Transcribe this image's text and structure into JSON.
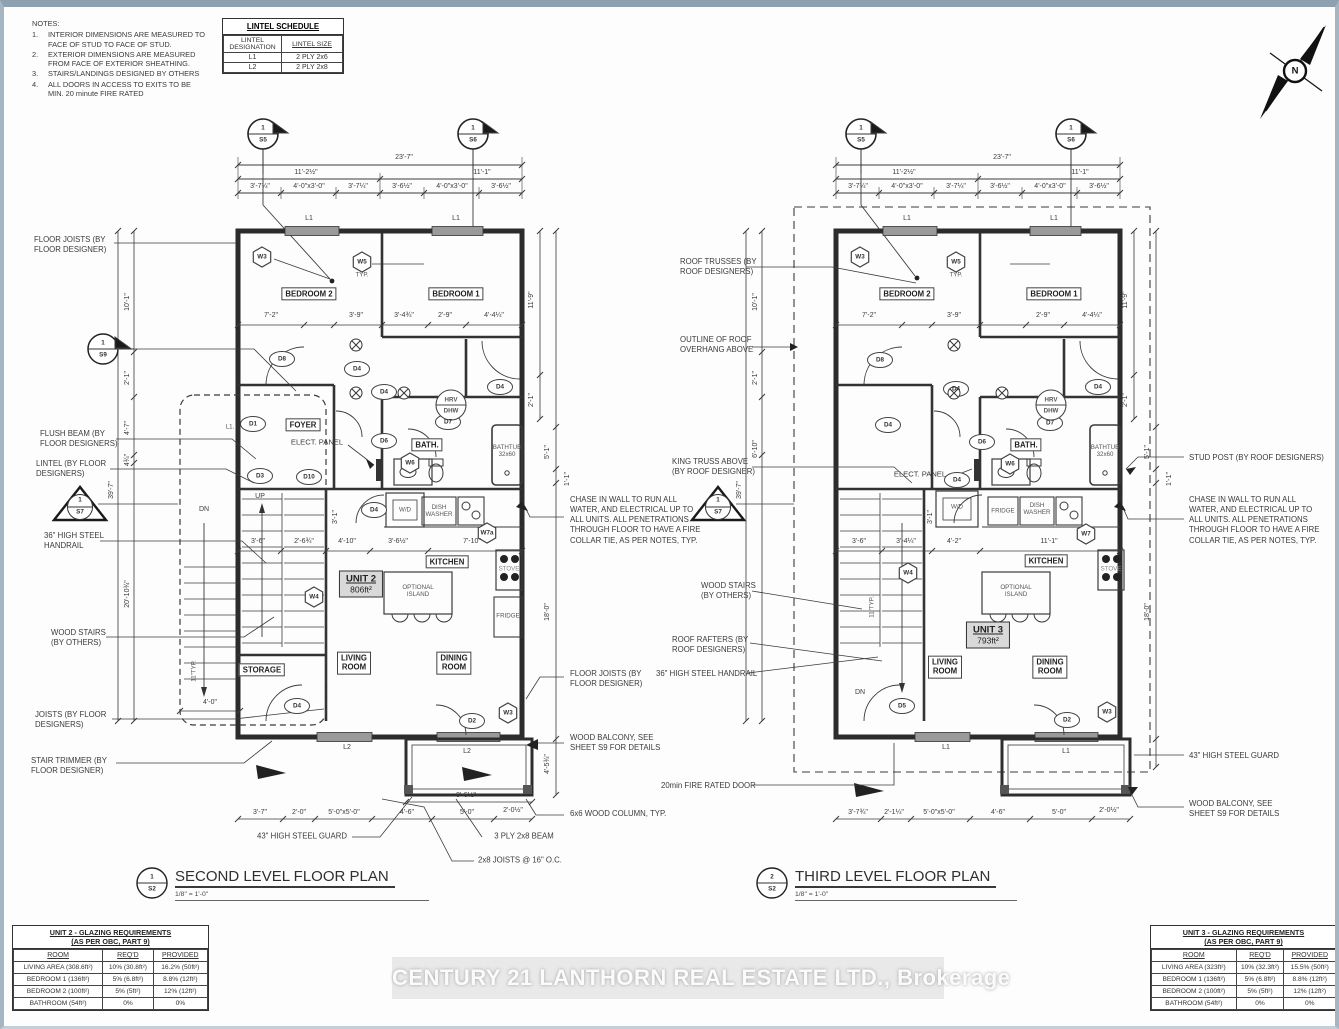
{
  "n": {
    "title": "NOTES:",
    "i1n": "1.",
    "i1": "INTERIOR DIMENSIONS ARE MEASURED TO\nFACE OF STUD TO FACE OF STUD.",
    "i2n": "2.",
    "i2": "EXTERIOR DIMENSIONS ARE MEASURED\nFROM FACE OF EXTERIOR SHEATHING.",
    "i3n": "3.",
    "i3": "STAIRS/LANDINGS DESIGNED BY OTHERS",
    "i4n": "4.",
    "i4": "ALL DOORS IN ACCESS TO EXITS TO BE\nMIN. 20 minute FIRE RATED"
  },
  "ls": {
    "title": "LINTEL SCHEDULE",
    "h1": "LINTEL\nDESIGNATION",
    "h2": "LINTEL SIZE",
    "r1c1": "L1",
    "r1c2": "2 PLY 2x6",
    "r2c1": "L2",
    "r2c2": "2 PLY 2x8"
  },
  "cmp": {
    "n": "N"
  },
  "p1": {
    "s5n": "1",
    "s5": "S5",
    "s6n": "1",
    "s6": "S6",
    "w": "23'-7\"",
    "wl": "11'-2½\"",
    "wr": "11'-1\"",
    "t1": "3'-7¼\"",
    "t2": "4'-0\"x3'-0\"",
    "t3": "3'-7¼\"",
    "t4": "3'-6½\"",
    "t5": "4'-0\"x3'-0\"",
    "t6": "3'-6½\"",
    "l1a": "L1",
    "l1b": "L1",
    "l1c": "L1.",
    "w3": "W3",
    "w5": "W5",
    "typ": "TYP.",
    "br2": "BEDROOM 2",
    "br1": "BEDROOM 1",
    "b1": "7'-2\"",
    "b2": "3'-9\"",
    "b3": "3'-4¾\"",
    "b4": "2'-9\"",
    "b5": "4'-4¼\"",
    "d8": "D8",
    "d4a": "D4",
    "d4b": "D4",
    "d4c": "D4",
    "hrv": "HRV",
    "dhw": "DHW",
    "d1": "D1",
    "foyer": "FOYER",
    "ep": "ELECT. PANEL",
    "d6": "D6",
    "bath": "BATH.",
    "d7": "D7",
    "tub": "BATHTUB\n32x60",
    "w6": "W6",
    "d3": "D3",
    "d10": "D10",
    "up": "UP",
    "dn": "DN",
    "d4d": "D4",
    "wd": "W/D",
    "dw": "DISH\nWASHER",
    "w7": "W7a",
    "m1": "3'-6\"",
    "m2": "2'-6¾\"",
    "m3": "4'-10\"",
    "m4": "3'-6½\"",
    "m5": "7'-10\"",
    "m6": "3'-1\"",
    "kit": "KITCHEN",
    "unit": "UNIT 2",
    "area": "806ft²",
    "isl": "OPTIONAL\nISLAND",
    "stove": "STOVE",
    "fridge": "FRIDGE",
    "w4": "W4",
    "lr": "LIVING\nROOM",
    "dr": "DINING\nROOM",
    "st": "STORAGE",
    "d4e": "D4",
    "d2": "D2",
    "w3b": "W3",
    "l2a": "L2",
    "l2b": "L2",
    "sv1": "11'-9\"",
    "sv2": "2'-1\"",
    "sv3": "5'-1\"",
    "sv4": "1'-1\"",
    "sv5": "18'-0\"",
    "sv6": "4'-5¾\"",
    "lv1": "10'-1\"",
    "lv2": "2'-1\"",
    "lv3": "4'-7\"",
    "lv4": "4¾\"",
    "lv5": "39'-7\"",
    "lv6": "20'-10¾\"",
    "lv7": "11\"TYP.",
    "lv8": "4'-0\"",
    "g1": "3'-7\"",
    "g2": "2'-0\"",
    "g3": "5'-0\"x5'-0\"",
    "g4": "4'-6\"",
    "g5": "5'-0\"",
    "g6": "2'-0½\"",
    "g7": "9'-6½\"",
    "refn": "1",
    "refs": "S2",
    "title": "SECOND LEVEL FLOOR PLAN",
    "scale": "1/8\" = 1'-0\""
  },
  "p2": {
    "s5n": "1",
    "s5": "S5",
    "s6n": "1",
    "s6": "S6",
    "w": "23'-7\"",
    "wl": "11'-2½\"",
    "wr": "11'-1\"",
    "t1": "3'-7¼\"",
    "t2": "4'-0\"x3'-0\"",
    "t3": "3'-7¼\"",
    "t4": "3'-6½\"",
    "t5": "4'-0\"x3'-0\"",
    "t6": "3'-6½\"",
    "l1a": "L1",
    "l1b": "L1",
    "l1c": "L1",
    "l1d": "L1",
    "w3": "W3",
    "w5": "W5",
    "typ": "TYP.",
    "br2": "BEDROOM 2",
    "br1": "BEDROOM 1",
    "b1": "7'-2\"",
    "b2": "3'-9\"",
    "b4": "2'-9\"",
    "b5": "4'-4¼\"",
    "d8": "D8",
    "d4a": "D4",
    "d4b": "D4",
    "d4c": "D4",
    "hrv": "HRV",
    "dhw": "DHW",
    "ep": "ELECT. PANEL",
    "d6": "D6",
    "bath": "BATH.",
    "d7": "D7",
    "tub": "BATHTUB\n32x60",
    "w6": "W6",
    "d4d": "D4",
    "wd": "W/D",
    "dw": "DISH\nWASHER",
    "fridge": "FRIDGE",
    "w7": "W7",
    "stm": "3'-6\"",
    "m1": "3'-4¼\"",
    "m2": "4'-2\"",
    "m3": "11'-1\"",
    "m6": "3'-1\"",
    "kit": "KITCHEN",
    "unit": "UNIT 3",
    "area": "793ft²",
    "isl": "OPTIONAL\nISLAND",
    "stove": "STOVE",
    "w4": "W4",
    "lr": "LIVING\nROOM",
    "dr": "DINING\nROOM",
    "dn": "DN",
    "d5": "D5",
    "d2": "D2",
    "w3b": "W3",
    "sv1": "11'-9\"",
    "sv2": "2'-1\"",
    "sv3": "5'-1\"",
    "sv4": "1'-1\"",
    "sv5": "18'-0\"",
    "lv1": "10'-1\"",
    "lv2": "2'-1\"",
    "lv3": "6'-10\"",
    "lv5": "39'-7\"",
    "lv7": "11\"TYP.",
    "g1": "3'-7¾\"",
    "g2": "2'-1¼\"",
    "g3": "5'-0\"x5'-0\"",
    "g4": "4'-6\"",
    "g5": "5'-0\"",
    "g6": "2'-0½\"",
    "refn": "2",
    "refs": "S2",
    "title": "THIRD LEVEL FLOOR PLAN",
    "scale": "1/8\" = 1'-0\""
  },
  "cl": {
    "fj": "FLOOR JOISTS (BY\nFLOOR DESIGNER)",
    "s9n": "1",
    "s9": "S9",
    "fb": "FLUSH BEAM (BY\nFLOOR DESIGNERS)",
    "li": "LINTEL (BY FLOOR\nDESIGNERS)",
    "s7n": "1",
    "s7": "S7",
    "hr": "36\" HIGH STEEL\nHANDRAIL",
    "ws": "WOOD STAIRS\n(BY OTHERS)",
    "jo": "JOISTS (BY FLOOR\nDESIGNERS)",
    "stt": "STAIR TRIMMER (BY\nFLOOR DESIGNER)"
  },
  "cm": {
    "rt": "ROOF TRUSSES (BY\nROOF DESIGNERS)",
    "oo": "OUTLINE OF ROOF\nOVERHANG ABOVE",
    "kt": "KING TRUSS ABOVE\n(BY ROOF DESIGNER)",
    "s7n": "1",
    "s7": "S7",
    "chase": "CHASE IN WALL TO RUN ALL\nWATER, AND ELECTRICAL UP TO\nALL UNITS. ALL PENETRATIONS\nTHROUGH FLOOR TO HAVE A FIRE\nCOLLAR TIE, AS PER NOTES, TYP.",
    "fj": "FLOOR JOISTS (BY\nFLOOR DESIGNER)",
    "wb": "WOOD BALCONY, SEE\nSHEET S9 FOR DETAILS",
    "col": "6x6 WOOD COLUMN, TYP.",
    "sg": "43\" HIGH STEEL GUARD",
    "ply": "3 PLY 2x8 BEAM",
    "j16": "2x8 JOISTS @ 16\" O.C.",
    "ws": "WOOD STAIRS\n(BY OTHERS)",
    "rr": "ROOF RAFTERS (BY\nROOF DESIGNERS)",
    "hr": "36\" HIGH STEEL HANDRAIL",
    "fd": "20min FIRE RATED DOOR"
  },
  "cr": {
    "sp": "STUD POST (BY ROOF DESIGNERS)",
    "chase": "CHASE IN WALL TO RUN ALL\nWATER, AND ELECTRICAL UP TO\nALL UNITS. ALL PENETRATIONS\nTHROUGH FLOOR TO HAVE A FIRE\nCOLLAR TIE, AS PER NOTES, TYP.",
    "sg": "43\" HIGH STEEL GUARD",
    "wb": "WOOD BALCONY, SEE\nSHEET S9 FOR DETAILS"
  },
  "g1": {
    "t1": "UNIT 2 - GLAZING REQUIREMENTS",
    "t2": "(AS PER OBC, PART 9)",
    "h0": "ROOM",
    "h1": "REQ'D",
    "h2": "PROVIDED",
    "rows": [
      [
        "LIVING AREA (308.6ft²)",
        "10% (30.8ft²)",
        "16.2% (50ft²)"
      ],
      [
        "BEDROOM 1 (136ft²)",
        "5% (6.8ft²)",
        "8.8% (12ft²)"
      ],
      [
        "BEDROOM 2 (100ft²)",
        "5% (5ft²)",
        "12% (12ft²)"
      ],
      [
        "BATHROOM (54ft²)",
        "0%",
        "0%"
      ]
    ]
  },
  "g2": {
    "t1": "UNIT 3 - GLAZING REQUIREMENTS",
    "t2": "(AS PER OBC, PART 9)",
    "h0": "ROOM",
    "h1": "REQ'D",
    "h2": "PROVIDED",
    "rows": [
      [
        "LIVING AREA (323ft²)",
        "10% (32.3ft²)",
        "15.5% (50ft²)"
      ],
      [
        "BEDROOM 1 (136ft²)",
        "5% (6.8ft²)",
        "8.8% (12ft²)"
      ],
      [
        "BEDROOM 2 (100ft²)",
        "5% (5ft²)",
        "12% (12ft²)"
      ],
      [
        "BATHROOM (54ft²)",
        "0%",
        "0%"
      ]
    ]
  },
  "wm": {
    "text": "CENTURY 21 LANTHORN REAL ESTATE LTD., Brokerage"
  }
}
